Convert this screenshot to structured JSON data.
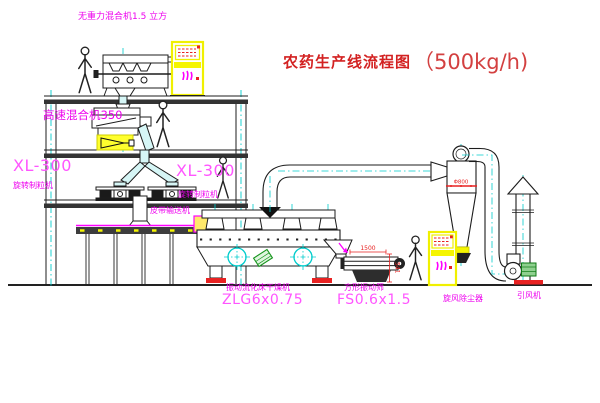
{
  "title": {
    "text_cn": "农药生产线流程图",
    "capacity": "（500kg/h)"
  },
  "labels": {
    "gravityless_mixer": "无重力混合机1.5 立方",
    "high_speed_mixer": "高速混合机350",
    "granulator_left_model": "XL-300",
    "granulator_left_name": "旋转制粒机",
    "granulator_right_model": "XL-300",
    "granulator_right_name": "旋转制粒机",
    "belt_conveyor": "皮带输送机",
    "fluid_bed_dryer_name": "振动流化床干燥机",
    "fluid_bed_dryer_model": "ZLG6x0.75",
    "square_screen_name": "方形振动筛",
    "square_screen_model": "FS0.6x1.5",
    "cyclone_collector": "旋风除尘器",
    "induced_draft_fan": "引风机"
  },
  "dimensions": {
    "cyclone_diameter": "Φ800",
    "screen_length": "1500",
    "screen_height": "541"
  },
  "colors": {
    "line": "#1c1c1c",
    "centerline_cyan": "#00cccc",
    "pipe_fill_cyan": "#d6f6f6",
    "label_magenta": "#ee00ee",
    "title_red": "#d32222",
    "dimension_red": "#e82222",
    "highlight_yellow": "#f5f500",
    "motor_green": "#15941c"
  }
}
